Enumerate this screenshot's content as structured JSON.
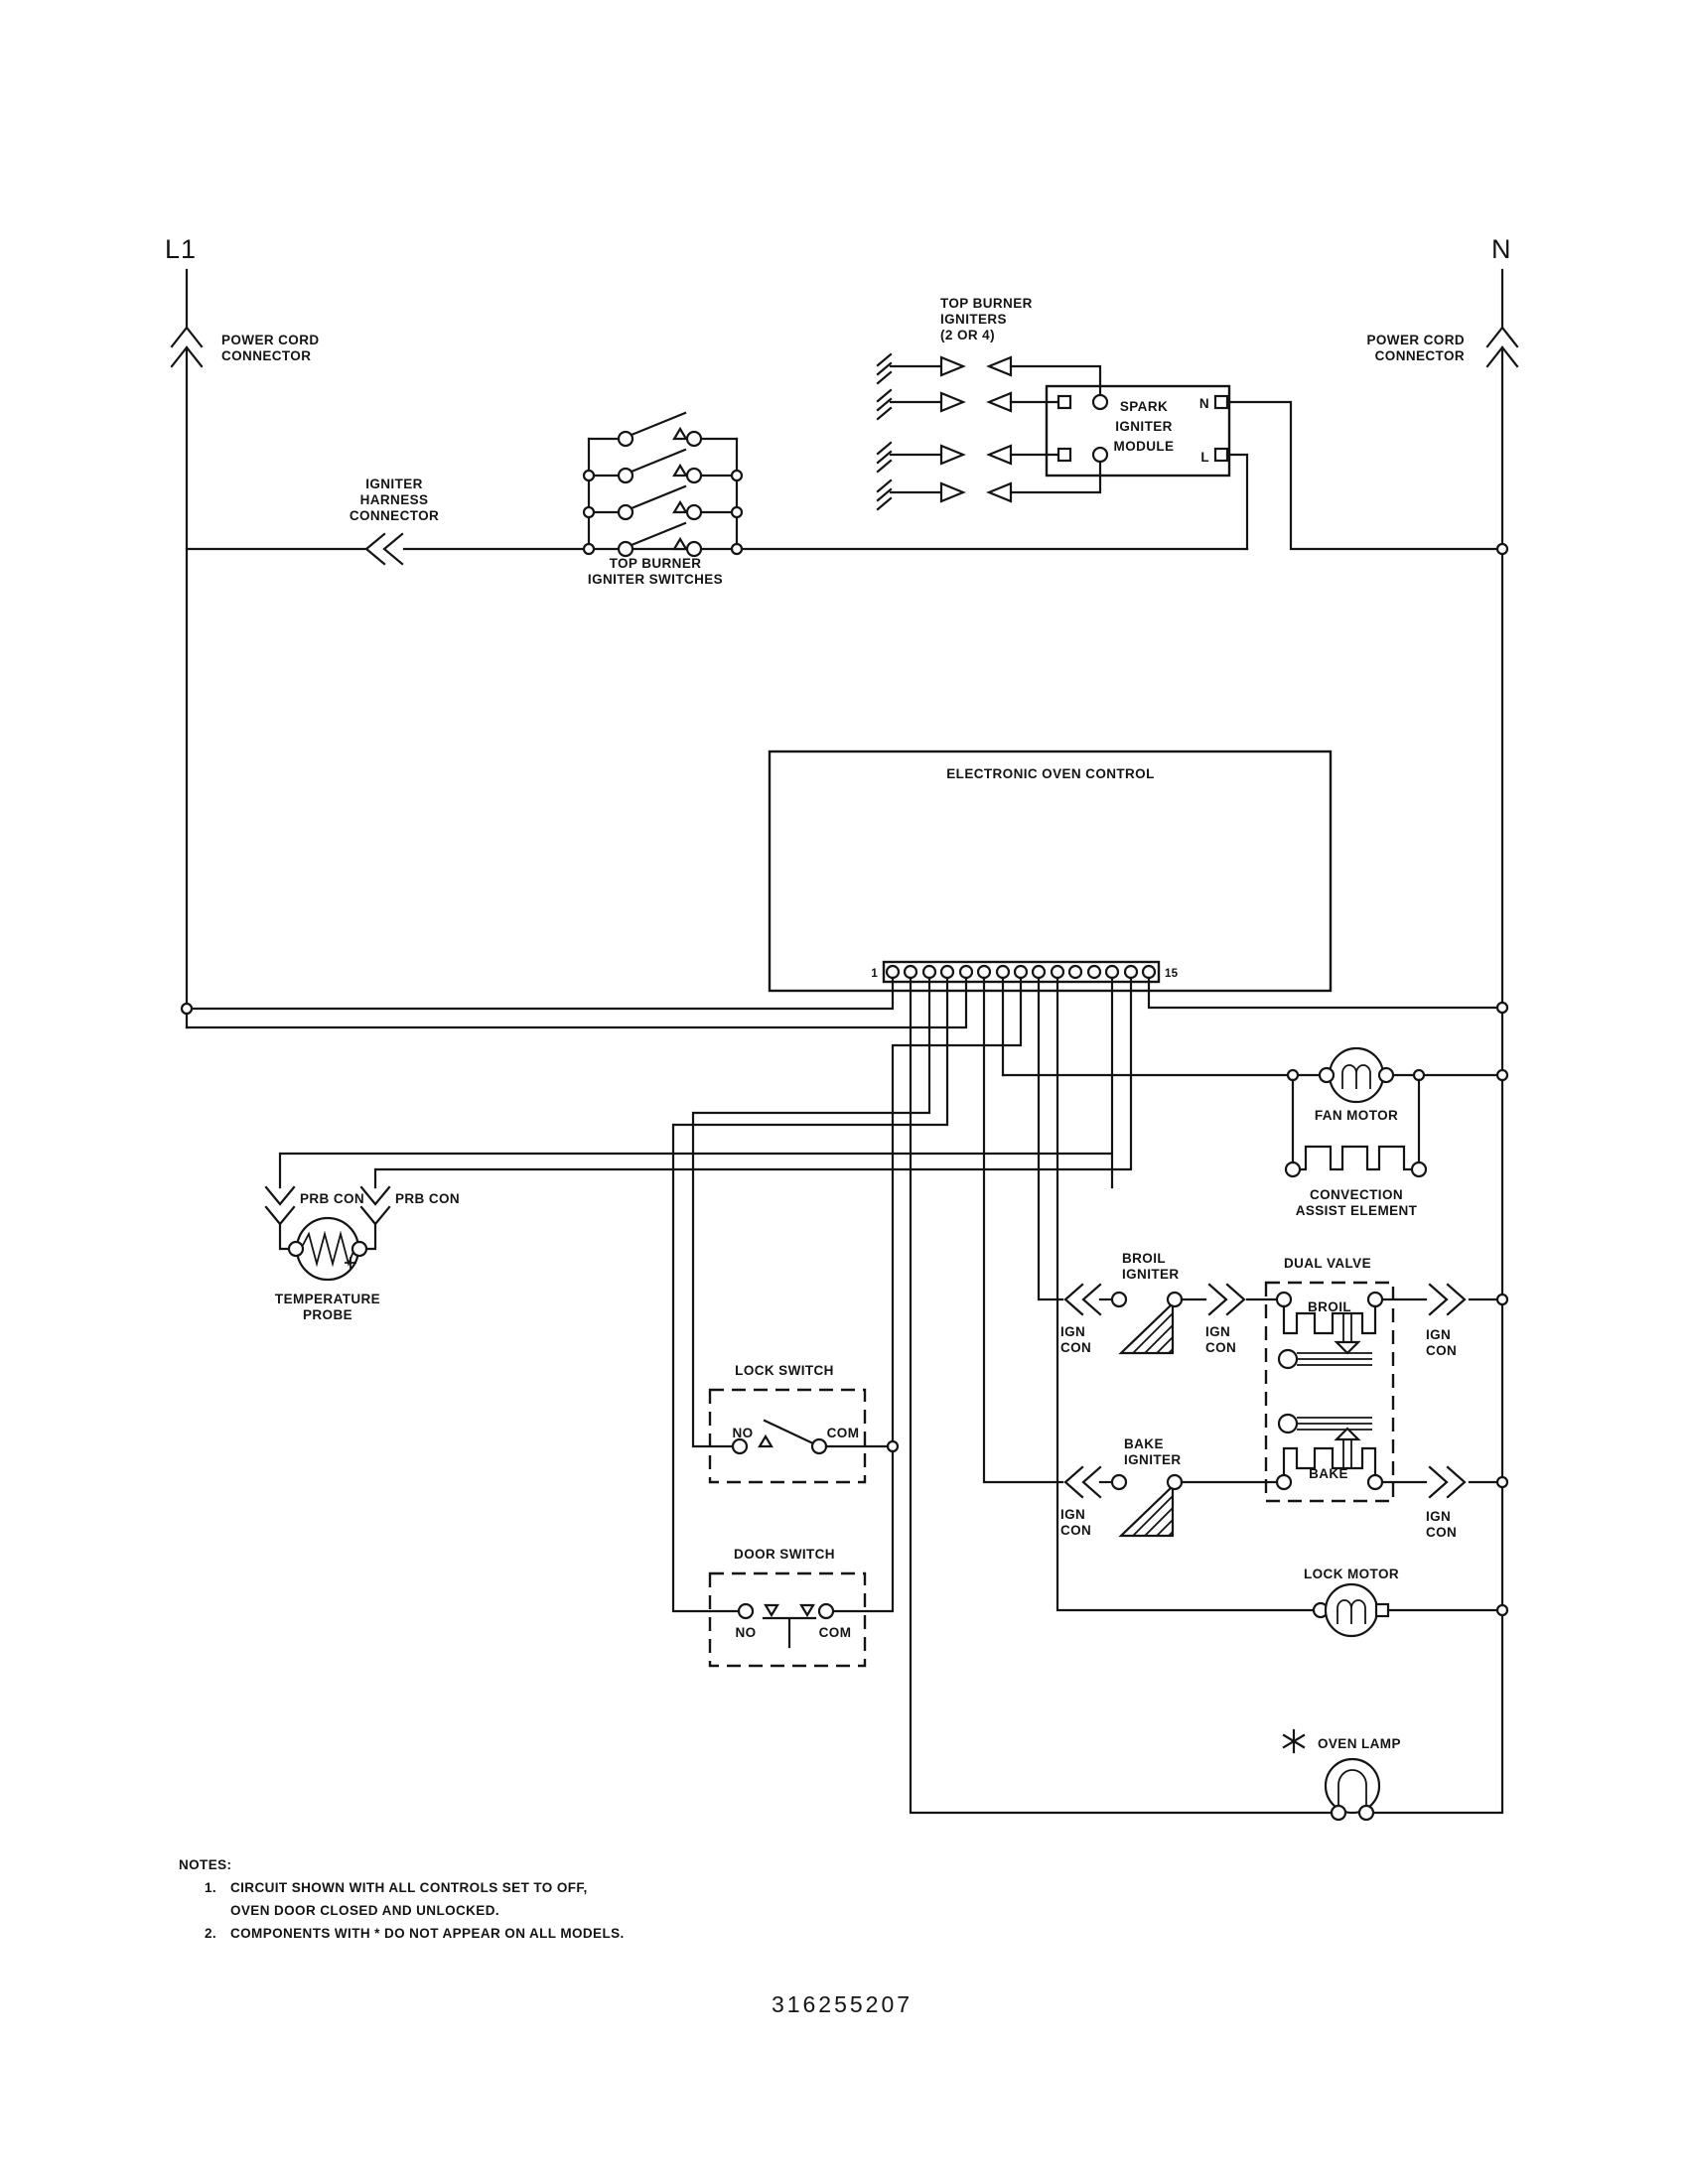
{
  "diagram": {
    "part_number": "316255207",
    "left_rail": "L1",
    "right_rail": "N",
    "power_cord_connector": [
      "POWER CORD",
      "CONNECTOR"
    ],
    "igniter_harness_connector": [
      "IGNITER",
      "HARNESS",
      "CONNECTOR"
    ],
    "top_burner_igniter_switches": [
      "TOP BURNER",
      "IGNITER SWITCHES"
    ],
    "top_burner_igniters": [
      "TOP BURNER",
      "IGNITERS",
      "(2 OR 4)"
    ],
    "spark_igniter_module": {
      "name": [
        "SPARK",
        "IGNITER",
        "MODULE"
      ],
      "n": "N",
      "l": "L"
    },
    "eoc": {
      "title": "ELECTRONIC OVEN CONTROL",
      "pin_first": "1",
      "pin_last": "15"
    },
    "fan_motor": "FAN MOTOR",
    "convection_assist_element": [
      "CONVECTION",
      "ASSIST ELEMENT"
    ],
    "prb_con": "PRB CON",
    "temperature_probe": [
      "TEMPERATURE",
      "PROBE"
    ],
    "broil_igniter": [
      "BROIL",
      "IGNITER"
    ],
    "bake_igniter": [
      "BAKE",
      "IGNITER"
    ],
    "ign_con": [
      "IGN",
      "CON"
    ],
    "dual_valve": {
      "title": "DUAL VALVE",
      "broil": "BROIL",
      "bake": "BAKE"
    },
    "lock_switch": {
      "title": "LOCK SWITCH",
      "no": "NO",
      "com": "COM"
    },
    "door_switch": {
      "title": "DOOR SWITCH",
      "no": "NO",
      "com": "COM"
    },
    "lock_motor": "LOCK MOTOR",
    "oven_lamp": "OVEN LAMP",
    "notes": {
      "heading": "NOTES:",
      "n1_num": "1.",
      "n1_line1": "CIRCUIT SHOWN WITH ALL CONTROLS SET TO OFF,",
      "n1_line2": "OVEN DOOR CLOSED AND UNLOCKED.",
      "n2_num": "2.",
      "n2_line1": "COMPONENTS WITH  *  DO NOT APPEAR ON ALL MODELS."
    }
  }
}
